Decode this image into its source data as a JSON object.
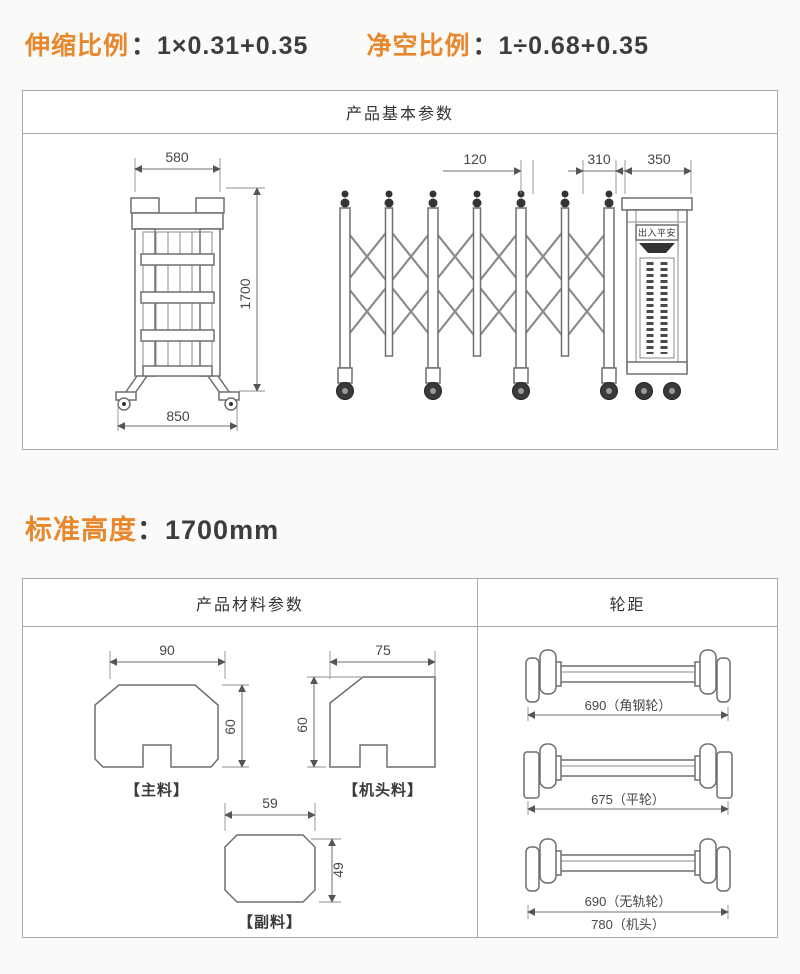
{
  "ratios": {
    "stretch_label": "伸缩比例",
    "stretch_value": "：1×0.31+0.35",
    "clear_label": "净空比例",
    "clear_value": "：1÷0.68+0.35"
  },
  "basic_panel": {
    "title": "产品基本参数",
    "dims": {
      "folded_width": "580",
      "height": "1700",
      "folded_base": "850",
      "post_gap": "120",
      "tail_gap": "310",
      "head_width": "350"
    },
    "head_sign": "出入平安"
  },
  "height_line": {
    "label": "标准高度",
    "value": "：1700mm"
  },
  "material_panel": {
    "title": "产品材料参数",
    "profiles": {
      "main": {
        "width": "90",
        "height": "60",
        "name": "【主料】"
      },
      "head": {
        "width": "75",
        "height": "60",
        "name": "【机头料】"
      },
      "sub": {
        "width": "59",
        "height": "49",
        "name": "【副料】"
      }
    }
  },
  "wheelbase_panel": {
    "title": "轮距",
    "rows": {
      "r1": "690（角钢轮）",
      "r2": "675（平轮）",
      "r3a": "690（无轨轮）",
      "r3b": "780（机头）"
    }
  },
  "colors": {
    "accent": "#e8872b",
    "line": "#6f6f6f",
    "border": "#a9a9a9"
  }
}
